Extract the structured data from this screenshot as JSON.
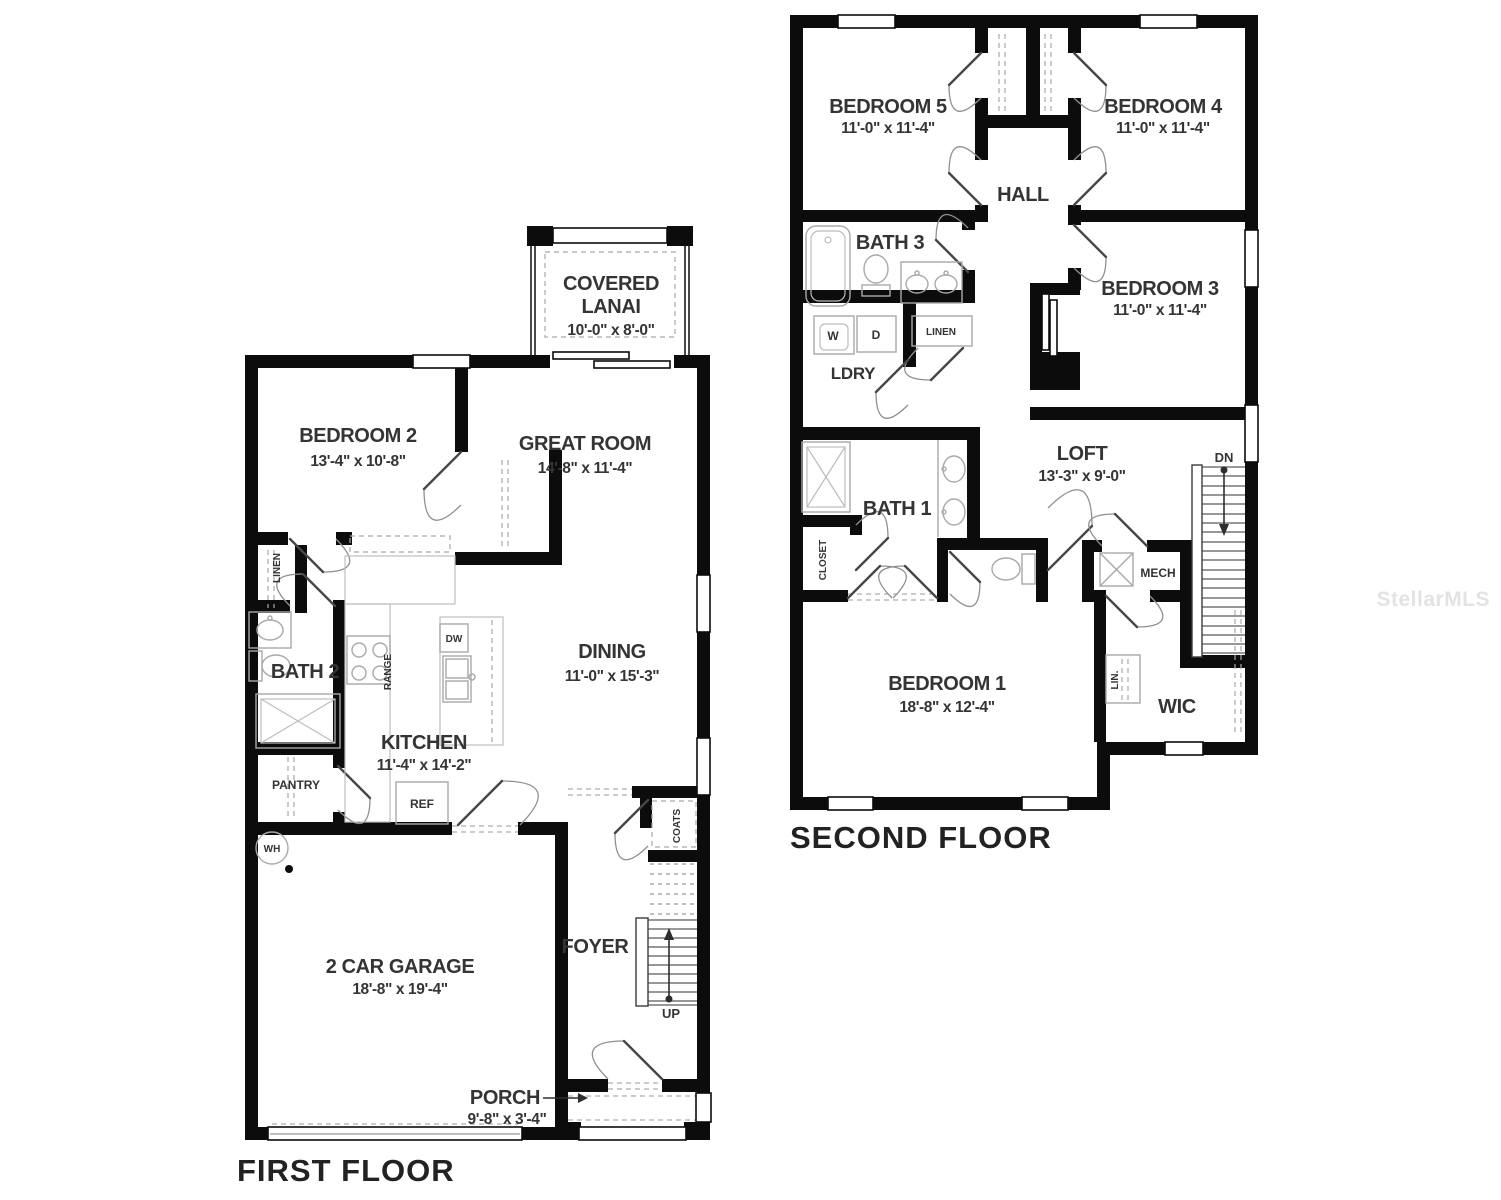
{
  "watermark": "StellarMLS",
  "first_floor": {
    "title": "FIRST FLOOR",
    "rooms": {
      "bedroom2": {
        "name": "BEDROOM 2",
        "dims": "13'-4\" x 10'-8\""
      },
      "great_room": {
        "name": "GREAT ROOM",
        "dims": "14'-8\" x 11'-4\""
      },
      "covered_lanai": {
        "line1": "COVERED",
        "line2": "LANAI",
        "dims": "10'-0\" x 8'-0\""
      },
      "dining": {
        "name": "DINING",
        "dims": "11'-0\" x 15'-3\""
      },
      "kitchen": {
        "name": "KITCHEN",
        "dims": "11'-4\" x 14'-2\""
      },
      "bath2": {
        "name": "BATH 2"
      },
      "garage": {
        "name": "2 CAR GARAGE",
        "dims": "18'-8\" x 19'-4\""
      },
      "foyer": {
        "name": "FOYER"
      },
      "porch": {
        "name": "PORCH",
        "dims": "9'-8\" x 3'-4\""
      }
    },
    "labels": {
      "linen": "LINEN",
      "pantry": "PANTRY",
      "range": "RANGE",
      "dw": "DW",
      "ref": "REF",
      "wh": "WH",
      "coats": "COATS",
      "up": "UP"
    }
  },
  "second_floor": {
    "title": "SECOND FLOOR",
    "rooms": {
      "bedroom5": {
        "name": "BEDROOM 5",
        "dims": "11'-0\" x 11'-4\""
      },
      "bedroom4": {
        "name": "BEDROOM 4",
        "dims": "11'-0\" x 11'-4\""
      },
      "bedroom3": {
        "name": "BEDROOM 3",
        "dims": "11'-0\" x 11'-4\""
      },
      "bedroom1": {
        "name": "BEDROOM 1",
        "dims": "18'-8\" x 12'-4\""
      },
      "hall": {
        "name": "HALL"
      },
      "bath3": {
        "name": "BATH 3"
      },
      "bath1": {
        "name": "BATH 1"
      },
      "ldry": {
        "name": "LDRY"
      },
      "loft": {
        "name": "LOFT",
        "dims": "13'-3\" x 9'-0\""
      },
      "wic": {
        "name": "WIC"
      }
    },
    "labels": {
      "washer": "W",
      "dryer": "D",
      "linen": "LINEN",
      "closet": "CLOSET",
      "mech": "MECH",
      "lin": "LIN.",
      "dn": "DN"
    }
  }
}
